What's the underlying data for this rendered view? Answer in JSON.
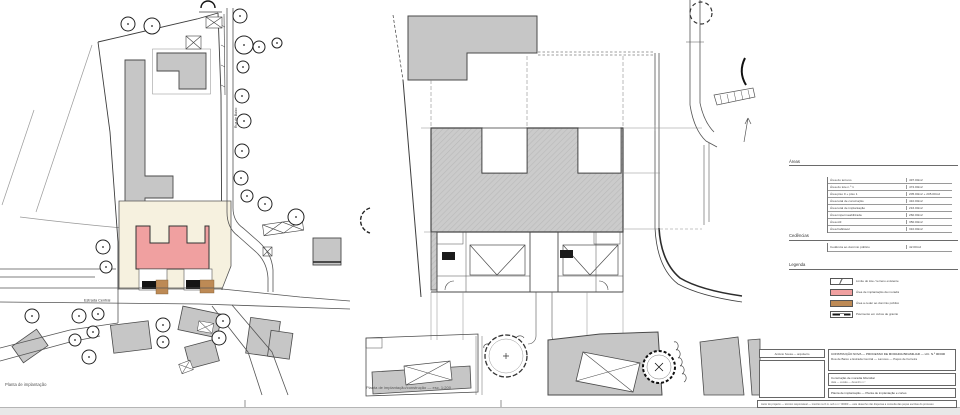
{
  "colors": {
    "new_building_pink": "#f0a0a0",
    "cession_tan": "#bd8a55",
    "existing_gray": "#c6c6c6",
    "lot_cream": "#f6f1df",
    "line": "#444444",
    "margin_gray": "#e8e8e8"
  },
  "plan_left": {
    "caption": "Planta de implantação",
    "road_label": "Estrada Central",
    "street_label": "Rua de Baixo"
  },
  "plan_middle": {
    "caption": "Planta de implantação/construção — esc. 1:200"
  },
  "legend": {
    "areas": {
      "title": "Áreas",
      "rows": [
        {
          "label": "Área do terreno",
          "value": "497.00m2"
        },
        {
          "label": "Área do lote n.º 1",
          "value": "472.00m2"
        },
        {
          "label": "Área piso 0 + piso 1",
          "value": "205.00m2 + 205.00m2"
        },
        {
          "label": "Área total de construção",
          "value": "410.00m2"
        },
        {
          "label": "Área total de implantação",
          "value": "216.00m2"
        },
        {
          "label": "Área impermeabilizada",
          "value": "260.00m2"
        },
        {
          "label": "Área útil",
          "value": "350.00m2"
        },
        {
          "label": "Área habitável",
          "value": "310.00m2"
        }
      ]
    },
    "cessions": {
      "title": "Cedências",
      "rows": [
        {
          "label": "Cedência ao domínio público",
          "value": "42.00m2"
        }
      ]
    },
    "key": {
      "title": "Legenda",
      "items": [
        {
          "type": "lot",
          "label": "Limite do lote / terreno existente"
        },
        {
          "type": "pink",
          "label": "Área de implantação da moradia"
        },
        {
          "type": "tan",
          "label": "Área a ceder ao domínio público"
        },
        {
          "type": "paving",
          "label": "Pavimento em cubos de granito"
        }
      ]
    }
  },
  "titleblock": {
    "architect": "António Sousa — arquitecto",
    "project_line1": "CONSTRUÇÃO NOVA — PROCESSO DE MORADIA BIFAMILIAR — LIC. N.º 00/000",
    "project_line2": "Rua de Baixo e Estrada Central — Lamoso — Paços de Ferreira",
    "work_label": "Construção de moradia bifamiliar",
    "work_fields": "data — escala — desenho n.º",
    "drawing_label": "Planta de implantação — Planta de implantação e cortes",
    "footer": "Autor do projecto — técnico responsável — inscrito na O.A. sob o n.º 00000 — este desenho não dispensa a consulta das peças escritas do processo"
  }
}
